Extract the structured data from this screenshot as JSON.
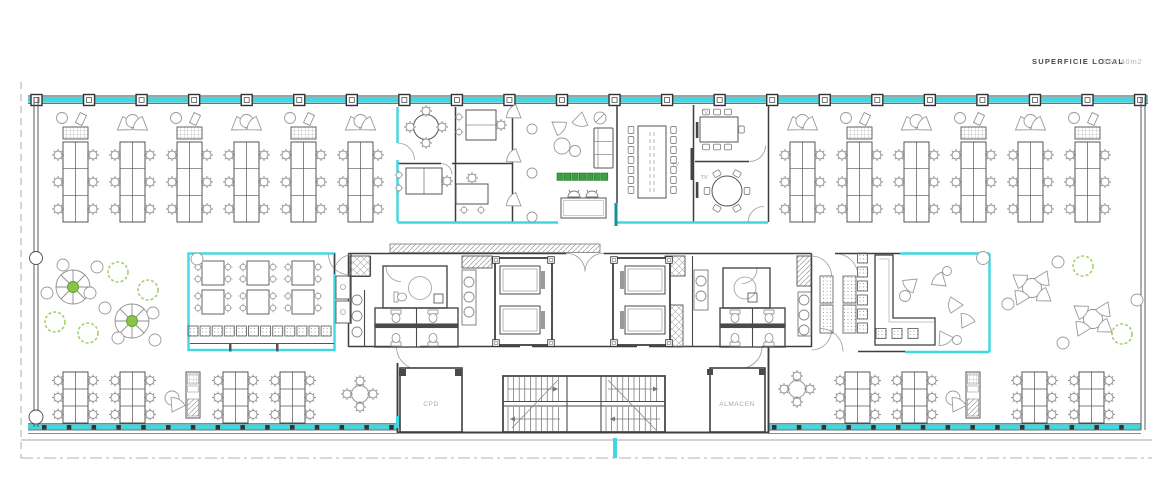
{
  "title": {
    "area_label": "SUPERFICIE LOCAL",
    "area_value": ": 950,40m2"
  },
  "rooms": {
    "cpd": "CPD",
    "almacen": "ALMACEN",
    "tv": "TV"
  },
  "colors": {
    "boundary_cyan": "#3fd8e0",
    "dark_teal_wall": "#16929b",
    "planter_green": "#3aa13f",
    "bush_green": "#a5d06e",
    "tree_center_green": "#8bc34a",
    "wall_dark": "#3f3f3f",
    "furniture_gray": "#8f8f8f",
    "label_gray": "#a8a8a8"
  }
}
